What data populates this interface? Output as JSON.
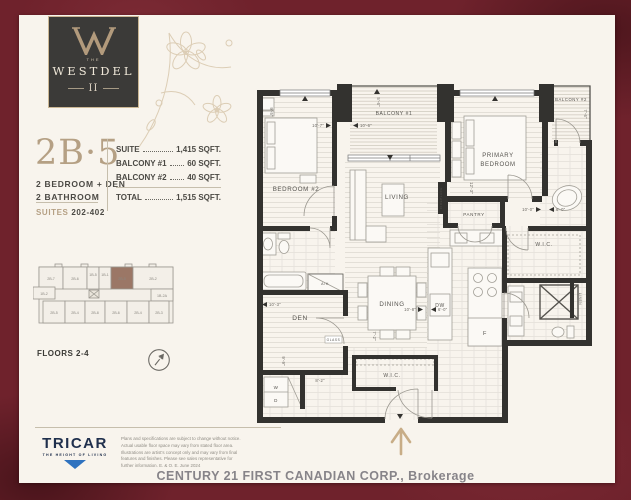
{
  "logo": {
    "the": "THE",
    "name": "WESTDEL",
    "numeral": "II"
  },
  "unit": {
    "code": "2B·5",
    "type_line1": "2 BEDROOM + DEN",
    "type_line2": "2 BATHROOM",
    "suites_label": "SUITES",
    "suites_range": "202-402",
    "specs": [
      {
        "label": "SUITE",
        "value": "1,415 SQFT."
      },
      {
        "label": "BALCONY #1",
        "value": "60 SQFT."
      },
      {
        "label": "BALCONY #2",
        "value": "40 SQFT."
      }
    ],
    "total": {
      "label": "TOTAL",
      "value": "1,515 SQFT."
    }
  },
  "keyplan": {
    "floors_label": "FLOORS 2-4",
    "highlighted_unit": "2B-5",
    "highlight_color": "#9b7766",
    "top_row": [
      "2B-7",
      "2B-6",
      "1B-5",
      "1B-1",
      "2B-5",
      "2B-2"
    ],
    "left_unit": "1B-2",
    "right_unit": "1B-2A",
    "bottom_row": [
      "2B-5",
      "2B-4",
      "2B-8",
      "2B-6",
      "2B-4",
      "2B-3"
    ]
  },
  "floorplan": {
    "rooms": {
      "bedroom2": "BEDROOM #2",
      "balcony1": "BALCONY #1",
      "balcony2": "BALCONY #2",
      "primary1": "PRIMARY",
      "primary2": "BEDROOM",
      "living": "LIVING",
      "dining": "DINING",
      "den": "DEN",
      "pantry": "PANTRY",
      "wic_primary": "W.I.C.",
      "wic_entry": "W.I.C.",
      "linen": "LINEN",
      "fireplace": "FIREPLACE",
      "ah": "A/H",
      "dw": "DW",
      "fridge": "F",
      "washer": "W",
      "dryer": "D",
      "glass": "GLASS"
    },
    "dims": {
      "bedroom2_w": "10'-7\"",
      "bedroom2_h": "9'-5\"",
      "balcony1_w": "10'-6\"",
      "balcony1_h": "5'-6\"",
      "balcony2_w": "7'-6\"",
      "primary_w": "10'-0\"",
      "primary_nook": "6'-0\"",
      "pantry_h": "12'-3\"",
      "dining_w": "10'-8\"",
      "dining_w2": "6'-0\"",
      "den_w": "10'-3\"",
      "den_h": "9'-9\"",
      "hall_w": "8'-2\"",
      "wic2_h": "7'-2\""
    },
    "compass": "N"
  },
  "footer": {
    "tricar_name": "TRICAR",
    "tricar_tagline": "THE HEIGHT OF LIVING",
    "disclaimer_lines": [
      "Plans and specifications are subject to change without notice.",
      "Actual usable floor space may vary from stated floor area.",
      "Illustrations are artist's concept only and may vary from final",
      "features and finishes. Please see sales representative for",
      "further information. E. & O. E. June 2024"
    ],
    "brokerage": "CENTURY 21 FIRST CANADIAN CORP., Brokerage"
  }
}
